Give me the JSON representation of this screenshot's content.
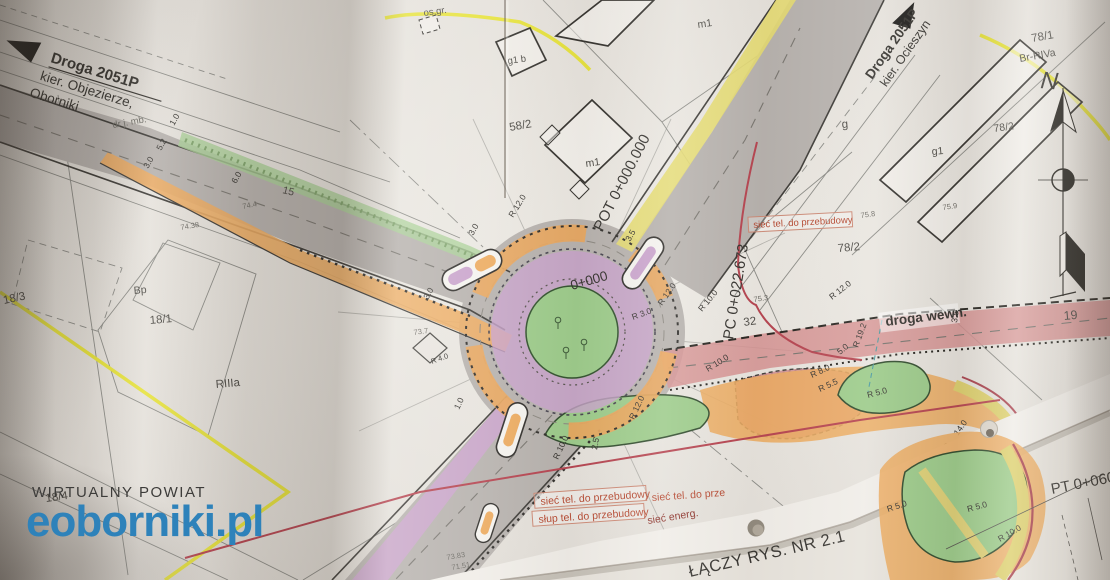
{
  "watermark": {
    "title": "WIRTUALNY POWIAT",
    "domain": "eoborniki.pl",
    "accent_color": "#2e82ba"
  },
  "roads": {
    "west_name": "Droga 2051P",
    "west_dir1": "kier. Objezierze,",
    "west_dir2": "Oborniki",
    "ne_name": "Droga 2051P",
    "ne_dir": "kier. Ocieszyn",
    "internal": "droga wewn.",
    "local": "dr j. mb."
  },
  "stations": {
    "pot": "POT 0+000.000",
    "zero": "0+000",
    "pc": "PC 0+022.673",
    "pt": "PT 0+060"
  },
  "notes": {
    "sheet_join": "ŁĄCZY RYS. NR 2.1",
    "north": "N"
  },
  "utilities": {
    "tel1": "sieć tel. do przebudowy",
    "pole": "słup tel. do przebudowy",
    "tel2": "sieć tel. do prze",
    "energ": "sieć energ.",
    "tel3": "sieć tel. do przebudowy"
  },
  "parcels": {
    "p78_1": "78/1",
    "soil": "Br-RIVa",
    "p78_2a": "78/2",
    "p78_2b": "78/2",
    "g": "g",
    "g1": "g1",
    "g1b": "g1 b",
    "m1a": "m1",
    "m1b": "m1",
    "p58_2": "58/2",
    "os_gr": "os.gr.",
    "p19": "19",
    "p15": "15",
    "p32": "32",
    "p18_1": "18/1",
    "p18_3": "18/3",
    "p18_4": "18/4",
    "bp": "Bp",
    "riiia": "RIIIa"
  },
  "radii": {
    "r12_w": "R 12.0",
    "r12_ne": "R 12.0",
    "r10_ne": "R 10.0",
    "r3": "R 3.0",
    "r10_e": "R 10.0",
    "r8": "R 8.0",
    "r55": "R 5.5",
    "r12_pc": "R 12.0",
    "r19": "R 19.2",
    "r4": "R 4.0",
    "r5a": "R 5.0",
    "r5b": "R 5.0",
    "r5c": "R 5.0",
    "r10_se": "R 10.0",
    "r12_s": "R 12.0",
    "r10_s": "R 10.0"
  },
  "dims": {
    "d30a": "3.0",
    "d35a": "3.5",
    "d30b": "3.0",
    "d10a": "1.0",
    "d25": "2.5",
    "d140": "14.0",
    "d50a": "5.0",
    "d20": "2.0",
    "d35b": "3.5",
    "d50b": "5.0",
    "d10b": "1.0",
    "d52": "5.2",
    "d30c": "3.0",
    "d60": "6.0"
  },
  "elev": {
    "e1": "74.4",
    "e2": "73.7",
    "e3": "75.8",
    "e4": "75.9",
    "e5": "74.38",
    "e6": "73.83",
    "e7": "71.51",
    "e8": "75.3"
  }
}
